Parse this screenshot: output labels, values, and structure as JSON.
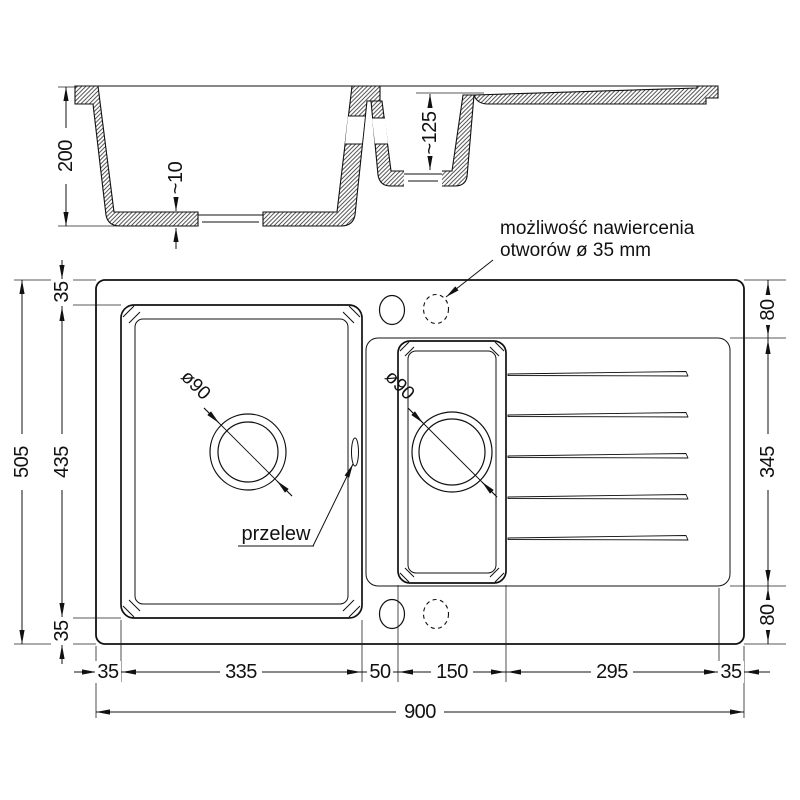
{
  "colors": {
    "ink": "#111111",
    "background": "#ffffff"
  },
  "section": {
    "depth_label": "200",
    "floor_label": "~10",
    "bowl2_depth_label": "~125"
  },
  "plan": {
    "drill_note": {
      "line1": "możliwość nawiercenia",
      "line2": "otworów ø 35 mm"
    },
    "overflow_label": "przelew",
    "main_drain_label": "ø90",
    "second_drain_label": "ø90",
    "dims": {
      "overall_height": "505",
      "overall_width": "900",
      "left_chain": [
        "35",
        "435",
        "35"
      ],
      "right_chain": [
        "80",
        "345",
        "80"
      ],
      "bottom_chain": [
        "35",
        "335",
        "50",
        "150",
        "295",
        "35"
      ]
    }
  }
}
